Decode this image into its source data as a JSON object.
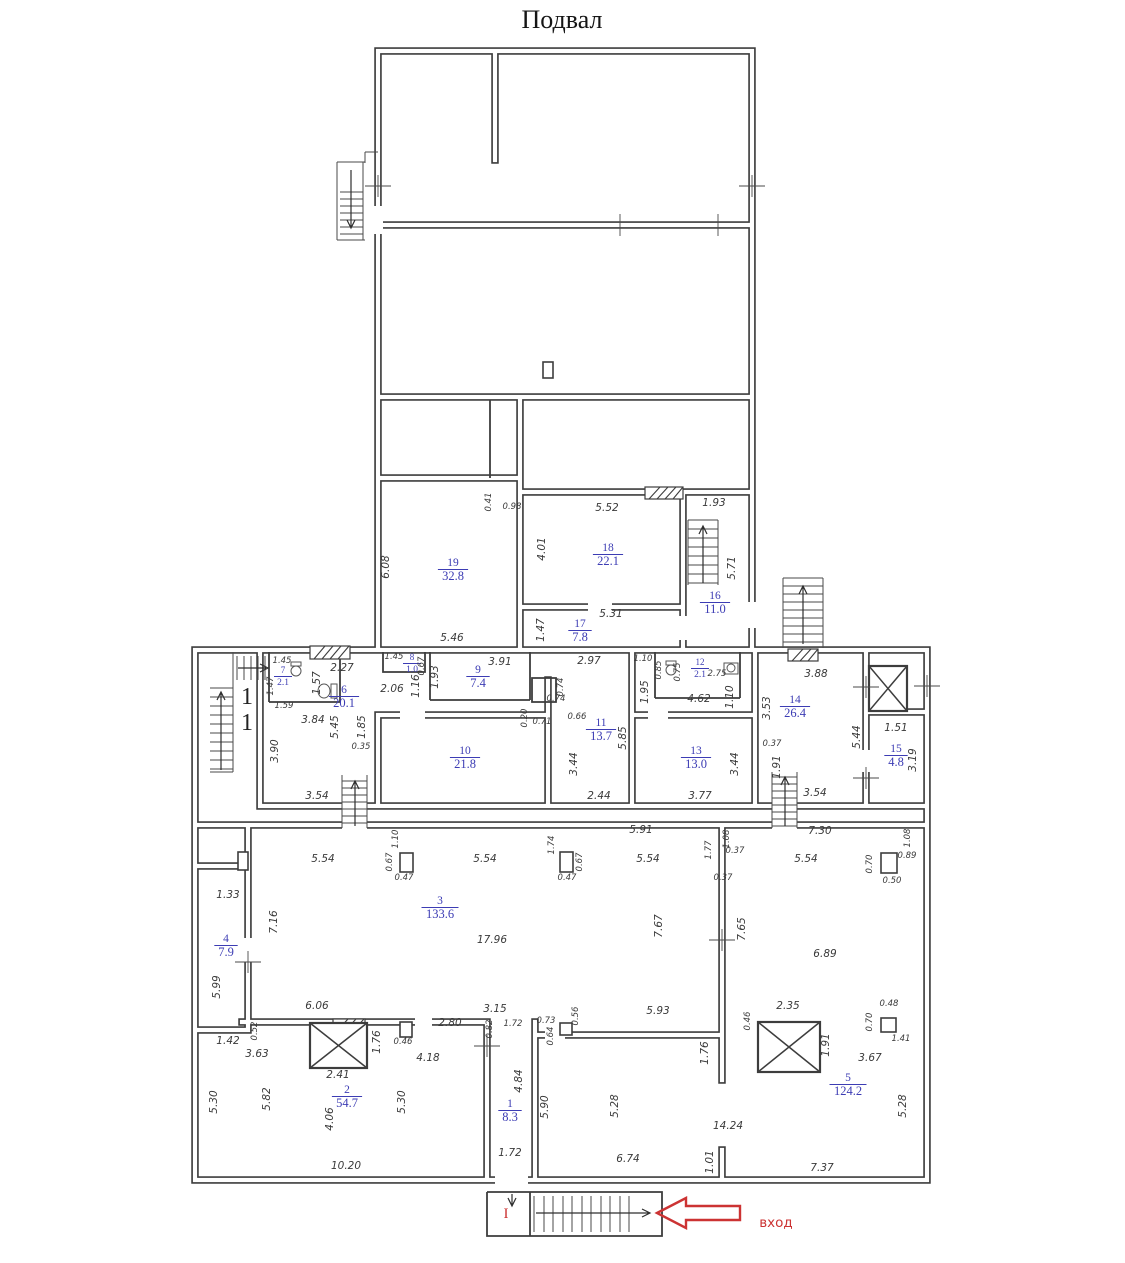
{
  "title": "Подвал",
  "colors": {
    "wall": "#3d3d3d",
    "dim_text": "#3a3a3a",
    "room_label": "#3c3cb4",
    "accent_red": "#cc3333",
    "background": "#ffffff"
  },
  "plan": {
    "entrance": {
      "label": "вход",
      "landing": "I"
    },
    "stair_marks": [
      {
        "t": "1",
        "x": 247,
        "y": 704
      },
      {
        "t": "1",
        "x": 247,
        "y": 730
      }
    ],
    "rooms": [
      {
        "n": "19",
        "a": "32.8",
        "x": 453,
        "y": 568
      },
      {
        "n": "18",
        "a": "22.1",
        "x": 608,
        "y": 553
      },
      {
        "n": "17",
        "a": "7.8",
        "x": 580,
        "y": 629
      },
      {
        "n": "16",
        "a": "11.0",
        "x": 715,
        "y": 601
      },
      {
        "n": "8",
        "a": "1.0",
        "x": 412,
        "y": 662,
        "s": 1
      },
      {
        "n": "7",
        "a": "2.1",
        "x": 283,
        "y": 675,
        "s": 1
      },
      {
        "n": "6",
        "a": "20.1",
        "x": 344,
        "y": 695
      },
      {
        "n": "9",
        "a": "7.4",
        "x": 478,
        "y": 675
      },
      {
        "n": "12",
        "a": "2.1",
        "x": 700,
        "y": 667,
        "s": 1
      },
      {
        "n": "14",
        "a": "26.4",
        "x": 795,
        "y": 705
      },
      {
        "n": "11",
        "a": "13.7",
        "x": 601,
        "y": 728
      },
      {
        "n": "10",
        "a": "21.8",
        "x": 465,
        "y": 756
      },
      {
        "n": "13",
        "a": "13.0",
        "x": 696,
        "y": 756
      },
      {
        "n": "15",
        "a": "4.8",
        "x": 896,
        "y": 754
      },
      {
        "n": "4",
        "a": "7.9",
        "x": 226,
        "y": 944
      },
      {
        "n": "3",
        "a": "133.6",
        "x": 440,
        "y": 906
      },
      {
        "n": "2",
        "a": "54.7",
        "x": 347,
        "y": 1095
      },
      {
        "n": "1",
        "a": "8.3",
        "x": 510,
        "y": 1109
      },
      {
        "n": "5",
        "a": "124.2",
        "x": 848,
        "y": 1083
      }
    ],
    "dims": [
      {
        "t": "6.08",
        "x": 389,
        "y": 567,
        "r": -90
      },
      {
        "t": "5.46",
        "x": 452,
        "y": 641
      },
      {
        "t": "0.41",
        "x": 491,
        "y": 502,
        "r": -90,
        "s": 1
      },
      {
        "t": "0.98",
        "x": 512,
        "y": 509,
        "s": 1
      },
      {
        "t": "5.52",
        "x": 607,
        "y": 511
      },
      {
        "t": "4.01",
        "x": 545,
        "y": 549,
        "r": -90
      },
      {
        "t": "1.93",
        "x": 714,
        "y": 506
      },
      {
        "t": "5.71",
        "x": 735,
        "y": 568,
        "r": -90
      },
      {
        "t": "5.31",
        "x": 611,
        "y": 617
      },
      {
        "t": "1.47",
        "x": 544,
        "y": 630,
        "r": -90
      },
      {
        "t": "1.45",
        "x": 282,
        "y": 663,
        "s": 1
      },
      {
        "t": "1.47",
        "x": 273,
        "y": 686,
        "r": -90,
        "s": 1
      },
      {
        "t": "1.59",
        "x": 284,
        "y": 708,
        "s": 1
      },
      {
        "t": "2.27",
        "x": 342,
        "y": 671
      },
      {
        "t": "1.57",
        "x": 320,
        "y": 683,
        "r": -90
      },
      {
        "t": "3.84",
        "x": 313,
        "y": 723
      },
      {
        "t": "5.45",
        "x": 338,
        "y": 727,
        "r": -90
      },
      {
        "t": "1.85",
        "x": 365,
        "y": 727,
        "r": -90
      },
      {
        "t": "3.90",
        "x": 278,
        "y": 751,
        "r": -90
      },
      {
        "t": "0.35",
        "x": 361,
        "y": 749,
        "s": 1
      },
      {
        "t": "3.54",
        "x": 317,
        "y": 799
      },
      {
        "t": "2.06",
        "x": 392,
        "y": 692
      },
      {
        "t": "1.16",
        "x": 419,
        "y": 686,
        "r": -90
      },
      {
        "t": "1.93",
        "x": 438,
        "y": 677,
        "r": -90
      },
      {
        "t": "3.91",
        "x": 500,
        "y": 665
      },
      {
        "t": "1.45",
        "x": 394,
        "y": 659,
        "s": 1
      },
      {
        "t": "0.67",
        "x": 424,
        "y": 666,
        "r": -90,
        "s": 1
      },
      {
        "t": "2.97",
        "x": 589,
        "y": 664
      },
      {
        "t": "0.74",
        "x": 563,
        "y": 687,
        "r": -90,
        "s": 1
      },
      {
        "t": "0.74",
        "x": 556,
        "y": 701,
        "s": 1
      },
      {
        "t": "0.20",
        "x": 527,
        "y": 718,
        "r": -90,
        "s": 1
      },
      {
        "t": "0.71",
        "x": 542,
        "y": 724,
        "s": 1
      },
      {
        "t": "0.66",
        "x": 577,
        "y": 719,
        "s": 1
      },
      {
        "t": "1.10",
        "x": 643,
        "y": 661,
        "s": 1
      },
      {
        "t": "0.85",
        "x": 661,
        "y": 670,
        "r": -90,
        "s": 1
      },
      {
        "t": "0.75",
        "x": 680,
        "y": 672,
        "r": -90,
        "s": 1
      },
      {
        "t": "2.75",
        "x": 717,
        "y": 676,
        "s": 1
      },
      {
        "t": "1.95",
        "x": 648,
        "y": 692,
        "r": -90
      },
      {
        "t": "4.62",
        "x": 699,
        "y": 702
      },
      {
        "t": "1.10",
        "x": 733,
        "y": 697,
        "r": -90
      },
      {
        "t": "3.53",
        "x": 770,
        "y": 708,
        "r": -90
      },
      {
        "t": "3.88",
        "x": 816,
        "y": 677
      },
      {
        "t": "5.85",
        "x": 626,
        "y": 738,
        "r": -90
      },
      {
        "t": "3.44",
        "x": 577,
        "y": 764,
        "r": -90
      },
      {
        "t": "2.44",
        "x": 599,
        "y": 799
      },
      {
        "t": "3.44",
        "x": 738,
        "y": 764,
        "r": -90
      },
      {
        "t": "3.77",
        "x": 700,
        "y": 799
      },
      {
        "t": "0.37",
        "x": 772,
        "y": 746,
        "s": 1
      },
      {
        "t": "1.91",
        "x": 780,
        "y": 767,
        "r": -90
      },
      {
        "t": "3.54",
        "x": 815,
        "y": 796
      },
      {
        "t": "5.44",
        "x": 860,
        "y": 737,
        "r": -90
      },
      {
        "t": "1.51",
        "x": 896,
        "y": 731
      },
      {
        "t": "3.19",
        "x": 916,
        "y": 760,
        "r": -90
      },
      {
        "t": "7.30",
        "x": 820,
        "y": 834
      },
      {
        "t": "1.08",
        "x": 910,
        "y": 838,
        "r": -90,
        "s": 1
      },
      {
        "t": "5.91",
        "x": 641,
        "y": 833
      },
      {
        "t": "5.54",
        "x": 323,
        "y": 862
      },
      {
        "t": "0.67",
        "x": 392,
        "y": 862,
        "r": -90,
        "s": 1
      },
      {
        "t": "1.10",
        "x": 398,
        "y": 839,
        "r": -90,
        "s": 1
      },
      {
        "t": "0.47",
        "x": 404,
        "y": 880,
        "s": 1
      },
      {
        "t": "5.54",
        "x": 485,
        "y": 862
      },
      {
        "t": "1.74",
        "x": 554,
        "y": 845,
        "r": -90,
        "s": 1
      },
      {
        "t": "0.67",
        "x": 582,
        "y": 862,
        "r": -90,
        "s": 1
      },
      {
        "t": "0.47",
        "x": 567,
        "y": 880,
        "s": 1
      },
      {
        "t": "5.54",
        "x": 648,
        "y": 862
      },
      {
        "t": "1.77",
        "x": 711,
        "y": 850,
        "r": -90,
        "s": 1
      },
      {
        "t": "0.37",
        "x": 735,
        "y": 853,
        "s": 1
      },
      {
        "t": "1.08",
        "x": 729,
        "y": 839,
        "r": -90,
        "s": 1
      },
      {
        "t": "0.37",
        "x": 723,
        "y": 880,
        "s": 1
      },
      {
        "t": "5.54",
        "x": 806,
        "y": 862
      },
      {
        "t": "0.70",
        "x": 872,
        "y": 864,
        "r": -90,
        "s": 1
      },
      {
        "t": "0.89",
        "x": 907,
        "y": 858,
        "s": 1
      },
      {
        "t": "0.50",
        "x": 892,
        "y": 883,
        "s": 1
      },
      {
        "t": "1.33",
        "x": 228,
        "y": 898
      },
      {
        "t": "7.16",
        "x": 277,
        "y": 922,
        "r": -90
      },
      {
        "t": "5.99",
        "x": 220,
        "y": 987,
        "r": -90
      },
      {
        "t": "17.96",
        "x": 492,
        "y": 943
      },
      {
        "t": "7.67",
        "x": 662,
        "y": 926,
        "r": -90
      },
      {
        "t": "7.65",
        "x": 745,
        "y": 929,
        "r": -90
      },
      {
        "t": "6.89",
        "x": 825,
        "y": 957
      },
      {
        "t": "6.06",
        "x": 317,
        "y": 1009
      },
      {
        "t": "0.52",
        "x": 257,
        "y": 1031,
        "r": -90,
        "s": 1
      },
      {
        "t": "1.42",
        "x": 228,
        "y": 1044
      },
      {
        "t": "3.63",
        "x": 257,
        "y": 1057
      },
      {
        "t": "2.80",
        "x": 450,
        "y": 1026
      },
      {
        "t": "3.15",
        "x": 495,
        "y": 1012
      },
      {
        "t": "0.82",
        "x": 492,
        "y": 1029,
        "r": -90,
        "s": 1
      },
      {
        "t": "1.72",
        "x": 513,
        "y": 1026,
        "s": 1
      },
      {
        "t": "0.73",
        "x": 546,
        "y": 1023,
        "s": 1
      },
      {
        "t": "0.64",
        "x": 553,
        "y": 1036,
        "r": -90,
        "s": 1
      },
      {
        "t": "0.56",
        "x": 578,
        "y": 1016,
        "r": -90,
        "s": 1
      },
      {
        "t": "5.93",
        "x": 658,
        "y": 1014
      },
      {
        "t": "0.46",
        "x": 750,
        "y": 1021,
        "r": -90,
        "s": 1
      },
      {
        "t": "2.35",
        "x": 788,
        "y": 1009
      },
      {
        "t": "0.48",
        "x": 889,
        "y": 1006,
        "s": 1
      },
      {
        "t": "0.70",
        "x": 872,
        "y": 1022,
        "r": -90,
        "s": 1
      },
      {
        "t": "1.41",
        "x": 901,
        "y": 1041,
        "s": 1
      },
      {
        "t": "3.67",
        "x": 870,
        "y": 1061
      },
      {
        "t": "1.91",
        "x": 829,
        "y": 1045,
        "r": -90
      },
      {
        "t": "1.76",
        "x": 380,
        "y": 1042,
        "r": -90
      },
      {
        "t": "0.46",
        "x": 403,
        "y": 1044,
        "s": 1
      },
      {
        "t": "4.18",
        "x": 428,
        "y": 1061
      },
      {
        "t": "2.41",
        "x": 338,
        "y": 1078
      },
      {
        "t": "5.82",
        "x": 270,
        "y": 1099,
        "r": -90
      },
      {
        "t": "5.30",
        "x": 217,
        "y": 1102,
        "r": -90
      },
      {
        "t": "4.06",
        "x": 333,
        "y": 1119,
        "r": -90
      },
      {
        "t": "5.30",
        "x": 405,
        "y": 1102,
        "r": -90
      },
      {
        "t": "10.20",
        "x": 346,
        "y": 1169
      },
      {
        "t": "1.76",
        "x": 708,
        "y": 1053,
        "r": -90
      },
      {
        "t": "4.84",
        "x": 522,
        "y": 1081,
        "r": -90
      },
      {
        "t": "5.90",
        "x": 548,
        "y": 1107,
        "r": -90
      },
      {
        "t": "1.72",
        "x": 510,
        "y": 1156
      },
      {
        "t": "5.28",
        "x": 618,
        "y": 1106,
        "r": -90
      },
      {
        "t": "5.28",
        "x": 906,
        "y": 1106,
        "r": -90
      },
      {
        "t": "14.24",
        "x": 728,
        "y": 1129
      },
      {
        "t": "1.01",
        "x": 713,
        "y": 1162,
        "r": -90
      },
      {
        "t": "6.74",
        "x": 628,
        "y": 1162
      },
      {
        "t": "7.37",
        "x": 822,
        "y": 1171
      }
    ]
  }
}
